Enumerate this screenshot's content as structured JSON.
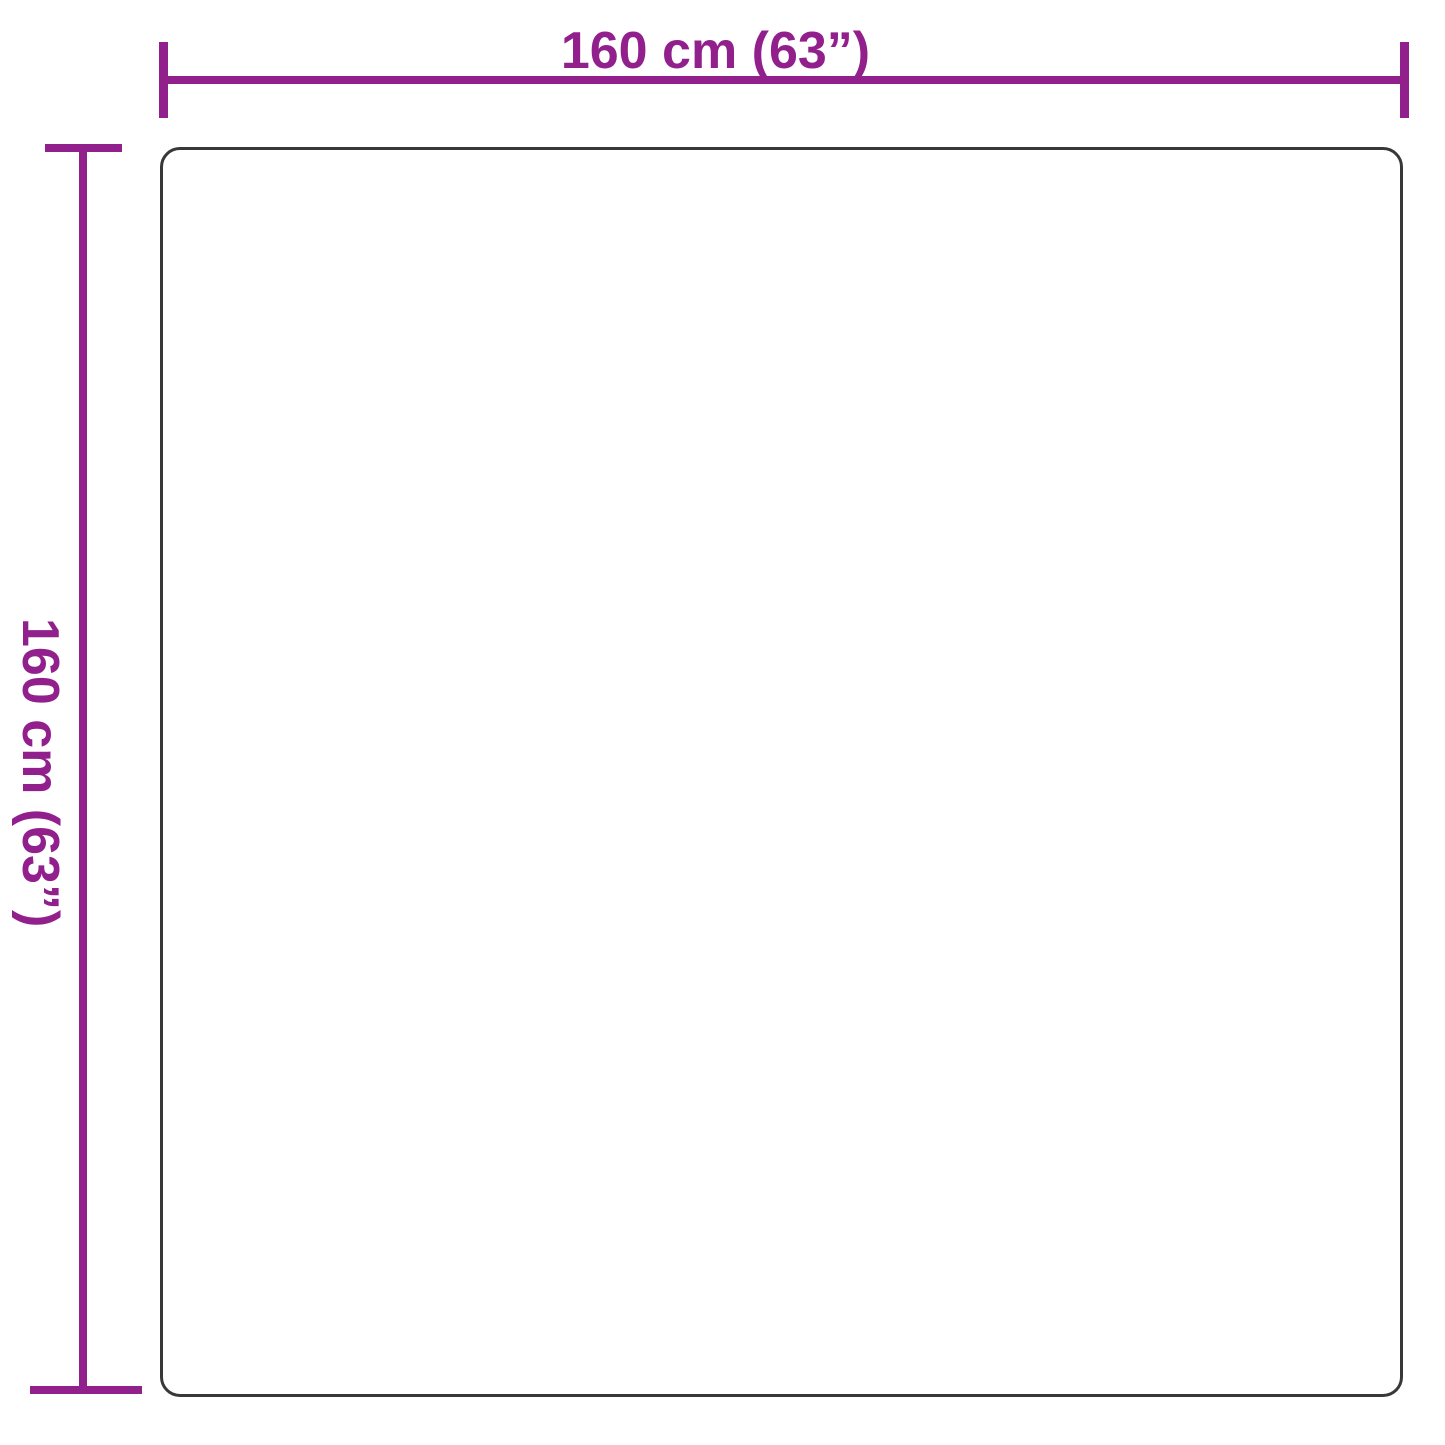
{
  "figure": {
    "type": "product-dimension-diagram",
    "product_shape": "rounded-square",
    "width_label": "160 cm (63”)",
    "height_label": "160 cm (63”)"
  },
  "colors": {
    "dimension_accent": "#92208c",
    "outline": "#383838",
    "background": "#ffffff"
  }
}
